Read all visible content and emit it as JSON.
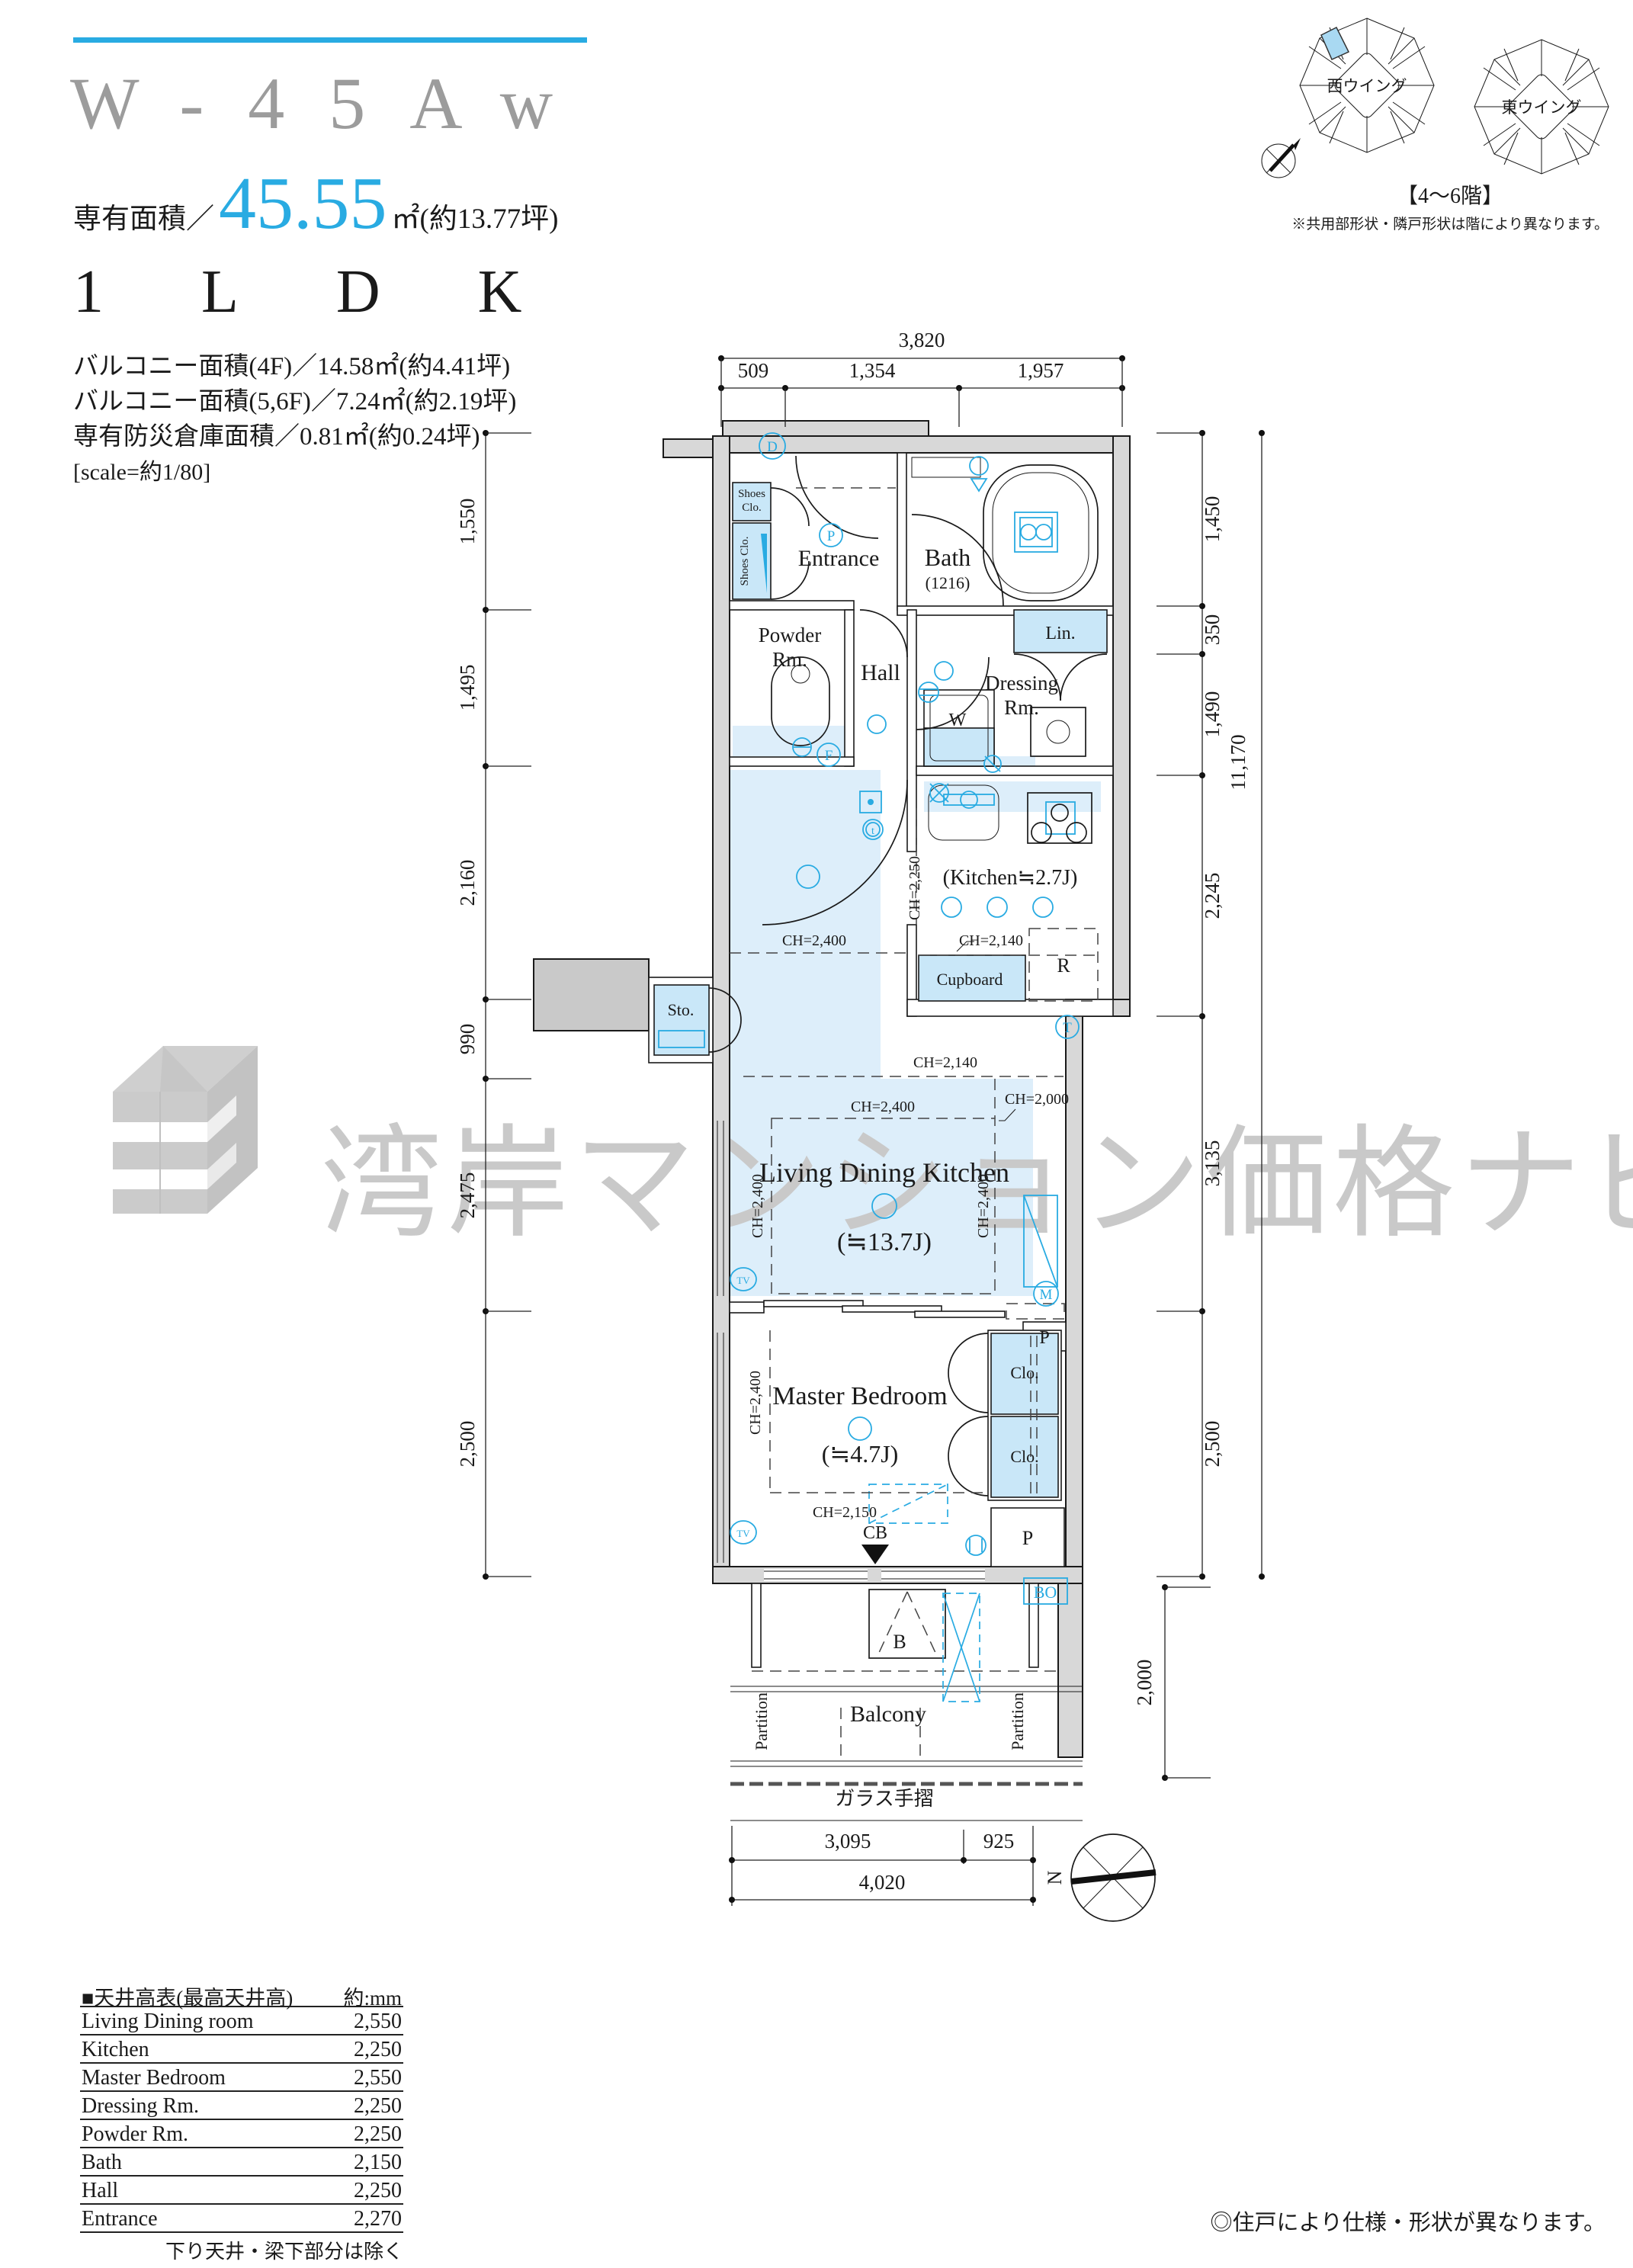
{
  "header": {
    "unit_code": "W-45Aw",
    "area_prefix": "専有面積／",
    "area_value": "45.55",
    "area_tsubo": "㎡(約13.77坪)",
    "layout_type": "1LDK",
    "balcony_4f": "バルコニー面積(4F)／14.58㎡(約4.41坪)",
    "balcony_56f": "バルコニー面積(5,6F)／7.24㎡(約2.19坪)",
    "storage_area": "専有防災倉庫面積／0.81㎡(約0.24坪)",
    "scale_note": "[scale=約1/80]"
  },
  "wings": {
    "west_label": "西ウイング",
    "east_label": "東ウイング",
    "floor_range": "【4〜6階】",
    "note": "※共用部形状・隣戸形状は階により異なります。"
  },
  "watermark": {
    "text": "湾岸マンション価格ナビ"
  },
  "plan": {
    "rooms": {
      "entrance": "Entrance",
      "bath": "Bath",
      "bath_size": "(1216)",
      "lin": "Lin.",
      "powder_l1": "Powder",
      "powder_l2": "Rm.",
      "hall": "Hall",
      "dressing_l1": "Dressing",
      "dressing_l2": "Rm.",
      "kitchen": "(Kitchen≒2.7J)",
      "ldk": "Living Dining Kitchen",
      "ldk_size": "(≒13.7J)",
      "bedroom": "Master Bedroom",
      "bedroom_size": "(≒4.7J)",
      "balcony": "Balcony",
      "shoes_l1": "Shoes",
      "shoes_l2": "Clo.",
      "shoes_tall": "Shoes Clo.",
      "sto": "Sto.",
      "cupboard": "Cupboard",
      "fridge": "R",
      "washer": "W",
      "clo": "Clo.",
      "pipe": "P",
      "bo": "BO",
      "b": "B",
      "cb": "CB",
      "partition": "Partition",
      "glass_rail": "ガラス手摺"
    },
    "ch": {
      "c2400": "CH=2,400",
      "c2250": "CH=2,250",
      "c2140": "CH=2,140",
      "c2150": "CH=2,150",
      "c2000": "CH=2,000"
    },
    "markers": {
      "d": "D",
      "p": "P",
      "f": "F",
      "t": "T",
      "m": "M",
      "tv": "TV",
      "t_small": "t"
    },
    "dims_top": {
      "total": "3,820",
      "segments": [
        "509",
        "1,354",
        "1,957"
      ]
    },
    "dims_left": [
      "1,550",
      "1,495",
      "2,160",
      "990",
      "2,475",
      "2,500"
    ],
    "dims_right": [
      "1,450",
      "350",
      "1,490",
      "2,245",
      "3,135",
      "2,500",
      "2,000"
    ],
    "dims_right_total": "11,170",
    "dims_bottom": {
      "segments": [
        "3,095",
        "925"
      ],
      "total": "4,020"
    }
  },
  "compass": {
    "north_label": "N"
  },
  "ceiling_table": {
    "title": "■天井高表(最高天井高)",
    "unit": "約:mm",
    "rows": [
      {
        "label": "Living Dining room",
        "value": "2,550"
      },
      {
        "label": "Kitchen",
        "value": "2,250"
      },
      {
        "label": "Master Bedroom",
        "value": "2,550"
      },
      {
        "label": "Dressing Rm.",
        "value": "2,250"
      },
      {
        "label": "Powder Rm.",
        "value": "2,250"
      },
      {
        "label": "Bath",
        "value": "2,150"
      },
      {
        "label": "Hall",
        "value": "2,250"
      },
      {
        "label": "Entrance",
        "value": "2,270"
      }
    ],
    "footnote": "下り天井・梁下部分は除く"
  },
  "footer_note": "◎住戸により仕様・形状が異なります。",
  "colors": {
    "accent": "#29abe2",
    "fixture_blue": "#c9e7f8",
    "floor_blue": "#ddeefa",
    "wall_gray": "#d8d8d8",
    "watermark_gray": "#c9c9c9",
    "title_gray": "#9c9c9c"
  }
}
